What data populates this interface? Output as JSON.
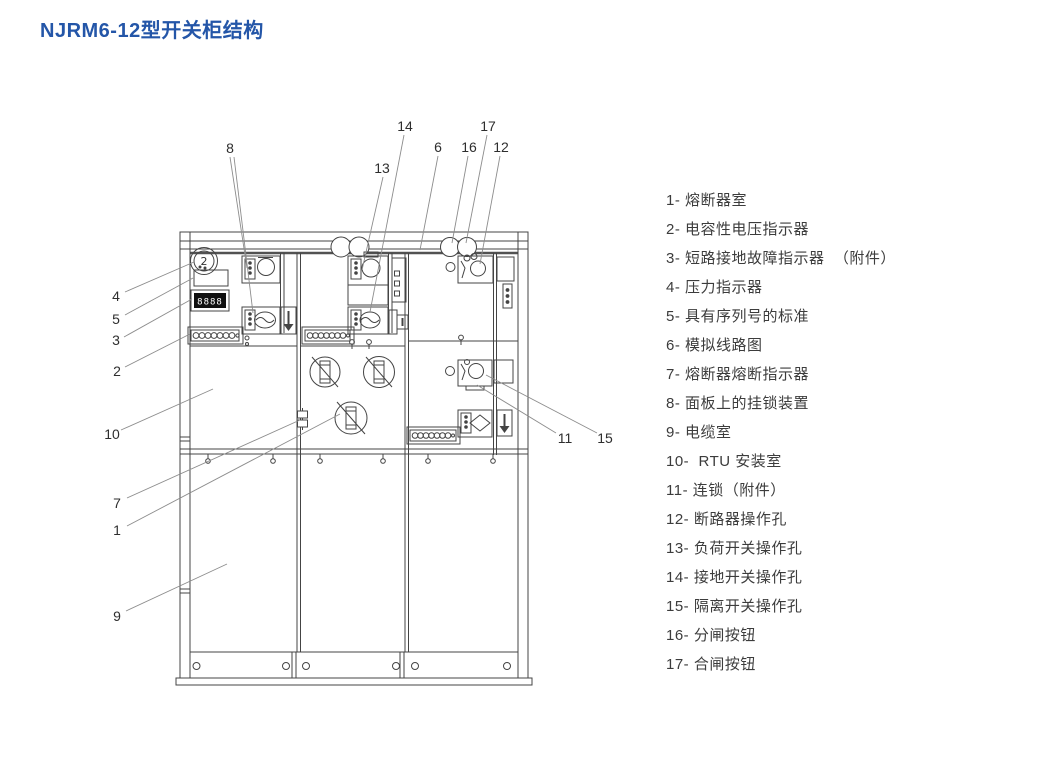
{
  "title": {
    "text": "NJRM6-12型开关柜结构"
  },
  "colors": {
    "title_blue": "#2456a8",
    "drawing_line": "#444444",
    "leader_line": "#8d8d8d",
    "display_background": "#101010",
    "display_digits": "#ffffff"
  },
  "diagram": {
    "description": "switchgear-cabinet-front-structure-drawing",
    "callouts": {
      "c1": "1",
      "c2": "2",
      "c3": "3",
      "c4": "4",
      "c5": "5",
      "c6": "6",
      "c7": "7",
      "c8": "8",
      "c9": "9",
      "c10": "10",
      "c11": "11",
      "c12": "12",
      "c13": "13",
      "c14": "14",
      "c15": "15",
      "c16": "16",
      "c17": "17"
    },
    "display_digits": "8888",
    "gauge_glyph": "2"
  },
  "legend": {
    "items": [
      "1- 熔断器室",
      "2- 电容性电压指示器",
      "3- 短路接地故障指示器  （附件）",
      "4- 压力指示器",
      "5- 具有序列号的标准",
      "6- 模拟线路图",
      "7- 熔断器熔断指示器",
      "8- 面板上的挂锁装置",
      "9- 电缆室",
      "10-  RTU 安装室",
      "11- 连锁（附件）",
      "12- 断路器操作孔",
      "13- 负荷开关操作孔",
      "14- 接地开关操作孔",
      "15- 隔离开关操作孔",
      "16- 分闸按钮",
      "17- 合闸按钮"
    ]
  }
}
